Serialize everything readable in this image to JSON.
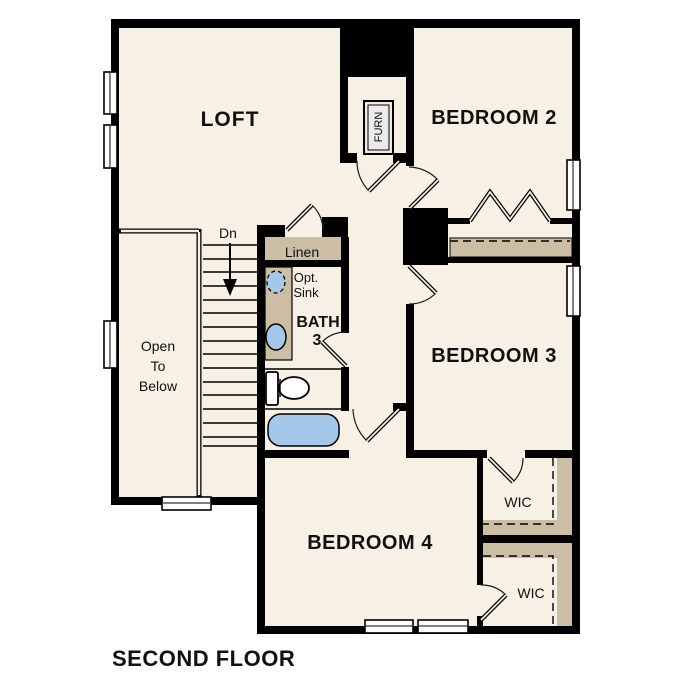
{
  "title": "SECOND FLOOR",
  "rooms": {
    "loft": "LOFT",
    "bedroom2": "BEDROOM 2",
    "bedroom3": "BEDROOM 3",
    "bedroom4": "BEDROOM 4",
    "bath_line1": "BATH",
    "bath_line2": "3",
    "wic1": "WIC",
    "wic2": "WIC",
    "linen": "Linen",
    "furnace": "FURN"
  },
  "annotations": {
    "stairs_down": "Dn",
    "open_below_line1": "Open",
    "open_below_line2": "To",
    "open_below_line3": "Below",
    "opt_sink_line1": "Opt.",
    "opt_sink_line2": "Sink"
  },
  "colors": {
    "wall": "#000000",
    "floor": "#F7F0E4",
    "shelf": "#CBBEA5",
    "fixture_blue": "#A5C7E9",
    "furn_fill": "#ECEBE7",
    "background": "#FFFFFF"
  }
}
